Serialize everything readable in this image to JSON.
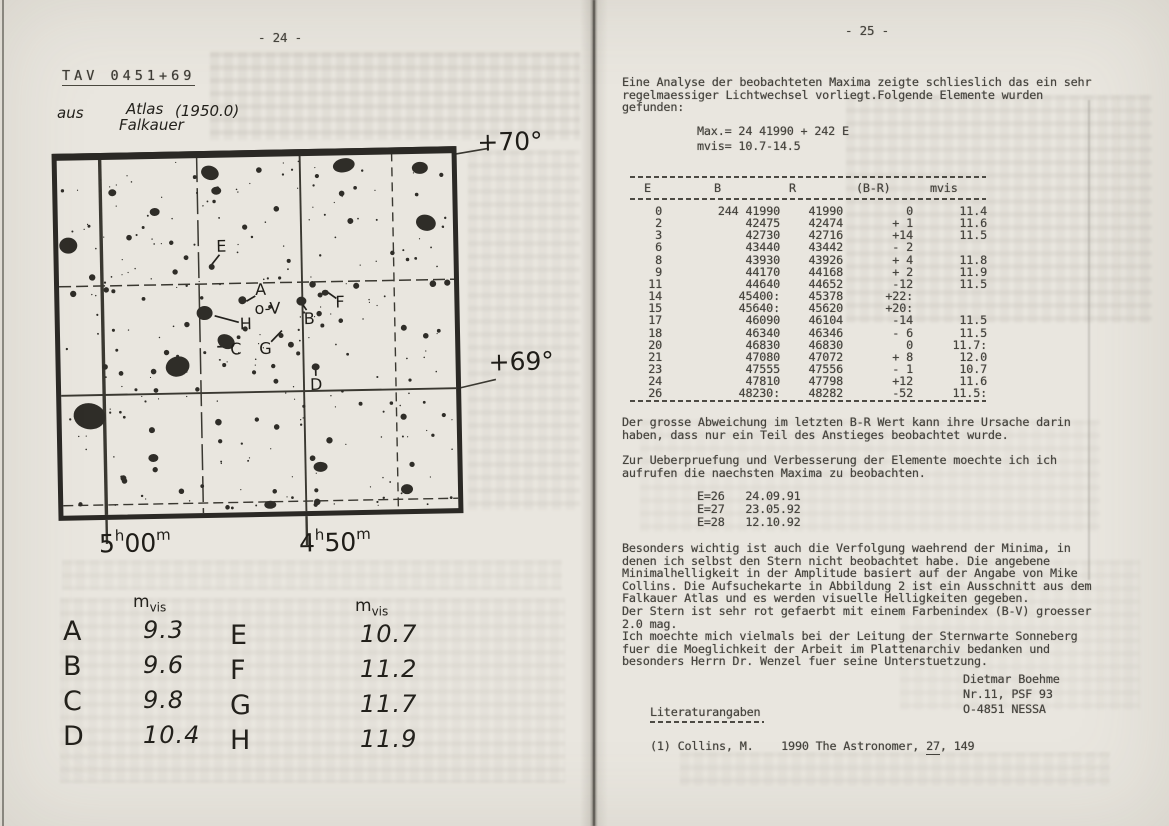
{
  "page_left": {
    "page_number": "- 24 -",
    "title": "TAV 0451+69",
    "note": {
      "aus": "aus",
      "atlas": "Atlas",
      "falkauer": "Falkauer",
      "epoch": "(1950.0)"
    },
    "chart": {
      "dec_top": "+70°",
      "dec_bottom": "+69°",
      "ra_left": {
        "num": "5",
        "sup": "h",
        "num2": "00",
        "sup2": "m"
      },
      "ra_right": {
        "num": "4",
        "sup": "h",
        "num2": "50",
        "sup2": "m"
      },
      "star_labels": [
        {
          "label": "E",
          "x": 163,
          "y": 88
        },
        {
          "label": "A",
          "x": 201,
          "y": 132
        },
        {
          "label": "o-V",
          "x": 200,
          "y": 151
        },
        {
          "label": "B",
          "x": 249,
          "y": 162
        },
        {
          "label": "F",
          "x": 281,
          "y": 146
        },
        {
          "label": "H",
          "x": 185,
          "y": 166
        },
        {
          "label": "C",
          "x": 175,
          "y": 191
        },
        {
          "label": "G",
          "x": 204,
          "y": 191
        },
        {
          "label": "D",
          "x": 254,
          "y": 228
        }
      ]
    },
    "mag_table": {
      "left": {
        "header_m": "m",
        "header_sub": "vis",
        "rows": [
          [
            "A",
            "9.3"
          ],
          [
            "B",
            "9.6"
          ],
          [
            "C",
            "9.8"
          ],
          [
            "D",
            "10.4"
          ]
        ]
      },
      "right": {
        "header_m": "m",
        "header_sub": "vis",
        "rows": [
          [
            "E",
            "10.7"
          ],
          [
            "F",
            "11.2"
          ],
          [
            "G",
            "11.7"
          ],
          [
            "H",
            "11.9"
          ]
        ]
      }
    }
  },
  "page_right": {
    "page_number": "- 25 -",
    "para1": "Eine Analyse der beobachteten Maxima zeigte schlieslich das ein sehr\nregelmaessiger Lichtwechsel vorliegt.Folgende Elemente wurden\ngefunden:",
    "elements": "Max.= 24 41990 + 242 E\nmvis= 10.7-14.5",
    "table": {
      "headers": [
        "E",
        "B",
        "R",
        "(B-R)",
        "mvis"
      ],
      "rows": [
        [
          "0",
          "244 41990",
          "41990",
          "0",
          "11.4"
        ],
        [
          "2",
          "42475",
          "42474",
          "+ 1",
          "11.6"
        ],
        [
          "3",
          "42730",
          "42716",
          "+14",
          "11.5"
        ],
        [
          "6",
          "43440",
          "43442",
          "- 2",
          ""
        ],
        [
          "8",
          "43930",
          "43926",
          "+ 4",
          "11.8"
        ],
        [
          "9",
          "44170",
          "44168",
          "+ 2",
          "11.9"
        ],
        [
          "11",
          "44640",
          "44652",
          "-12",
          "11.5"
        ],
        [
          "14",
          "45400:",
          "45378",
          "+22:",
          ""
        ],
        [
          "15",
          "45640:",
          "45620",
          "+20:",
          ""
        ],
        [
          "17",
          "46090",
          "46104",
          "-14",
          "11.5"
        ],
        [
          "18",
          "46340",
          "46346",
          "- 6",
          "11.5"
        ],
        [
          "20",
          "46830",
          "46830",
          "0",
          "11.7:"
        ],
        [
          "21",
          "47080",
          "47072",
          "+ 8",
          "12.0"
        ],
        [
          "23",
          "47555",
          "47556",
          "- 1",
          "10.7"
        ],
        [
          "24",
          "47810",
          "47798",
          "+12",
          "11.6"
        ],
        [
          "26",
          "48230:",
          "48282",
          "-52",
          "11.5:"
        ]
      ]
    },
    "para2": "Der grosse Abweichung im letzten B-R Wert kann ihre Ursache darin\nhaben, dass nur ein Teil des Anstieges beobachtet wurde.",
    "para3": "Zur Ueberpruefung und Verbesserung der Elemente moechte ich ich\naufrufen die naechsten Maxima zu beobachten.",
    "predictions": "E=26   24.09.91\nE=27   23.05.92\nE=28   12.10.92",
    "para4": "Besonders wichtig ist auch die Verfolgung waehrend der Minima, in\ndenen ich selbst den Stern nicht beobachtet habe. Die angebene\nMinimalhelligkeit in der Amplitude basiert auf der Angabe von Mike\nCollins. Die Aufsuchekarte in Abbildung 2 ist ein Ausschnitt aus dem\nFalkauer Atlas und es werden visuelle Helligkeiten gegeben.\nDer Stern ist sehr rot gefaerbt mit einem Farbenindex (B-V) groesser\n2.0 mag.\nIch moechte mich vielmals bei der Leitung der Sternwarte Sonneberg\nfuer die Moeglichkeit der Arbeit im Plattenarchiv bedanken und\nbesonders Herrn Dr. Wenzel fuer seine Unterstuetzung.",
    "signature": "Dietmar Boehme\nNr.11, PSF 93\nO-4851 NESSA",
    "literature_heading": "Literaturangaben",
    "reference": {
      "pre": "(1) Collins, M.    1990 The Astronomer, ",
      "volume": "27",
      "post": ", 149"
    }
  }
}
